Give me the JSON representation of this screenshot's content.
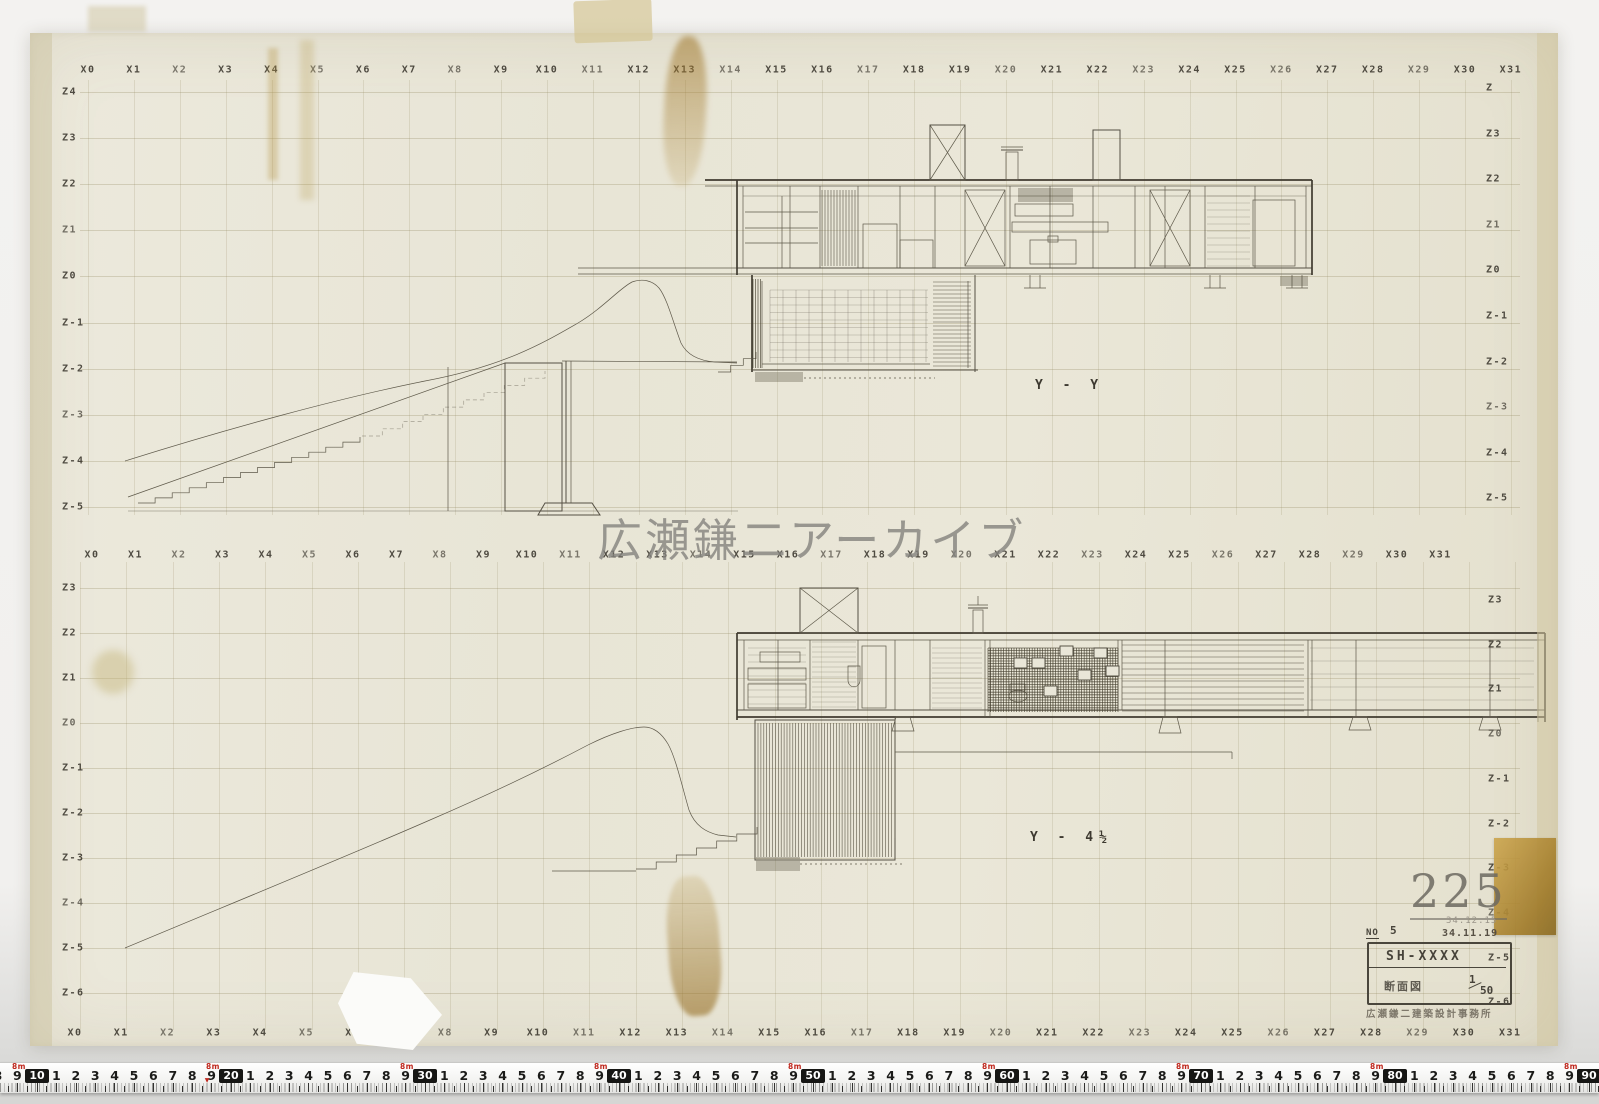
{
  "watermark": "広瀬鎌二アーカイブ",
  "axis": {
    "x_labels": [
      "X0",
      "X1",
      "X2",
      "X3",
      "X4",
      "X5",
      "X6",
      "X7",
      "X8",
      "X9",
      "X10",
      "X11",
      "X12",
      "X13",
      "X14",
      "X15",
      "X16",
      "X17",
      "X18",
      "X19",
      "X20",
      "X21",
      "X22",
      "X23",
      "X24",
      "X25",
      "X26",
      "X27",
      "X28",
      "X29",
      "X30",
      "X31"
    ],
    "z_upper_left": [
      "Z4",
      "Z3",
      "Z2",
      "Z1",
      "Z0",
      "Z-1",
      "Z-2",
      "Z-3",
      "Z-4",
      "Z-5"
    ],
    "z_upper_right": [
      "Z",
      "Z3",
      "Z2",
      "Z1",
      "Z0",
      "Z-1",
      "Z-2",
      "Z-3",
      "Z-4",
      "Z-5"
    ],
    "z_lower_left": [
      "Z3",
      "Z2",
      "Z1",
      "Z0",
      "Z-1",
      "Z-2",
      "Z-3",
      "Z-4",
      "Z-5",
      "Z-6"
    ],
    "z_lower_right": [
      "Z3",
      "Z2",
      "Z1",
      "Z0",
      "Z-1",
      "Z-2",
      "Z-3",
      "Z-4",
      "Z-5",
      "Z-6"
    ]
  },
  "sections": {
    "upper": "Y - Y",
    "lower": "Y - 4½"
  },
  "stamp_number": "225",
  "title_block": {
    "no_label": "NO",
    "no_value": "5",
    "date_faint": "34.12.15",
    "date": "34.11.19",
    "code": "SH-XXXX",
    "drawing_type": "断面図",
    "scale_numerator": "1",
    "scale_denominator": "50",
    "office": "広瀬鎌二建築設計事務所"
  },
  "ruler": {
    "meter_label": "8m",
    "boxes": [
      "10",
      "20",
      "30",
      "40",
      "50",
      "60",
      "70",
      "80",
      "90"
    ],
    "digits": [
      "1",
      "2",
      "3",
      "4",
      "5",
      "6",
      "7",
      "8",
      "9"
    ],
    "lead_digits": [
      "8",
      "9"
    ]
  },
  "colors": {
    "paper": "#e9e6d8",
    "ink": "#555044",
    "stamp_gray": "#6c6960",
    "accent_red": "#c0281e",
    "ruler_black": "#161614"
  }
}
